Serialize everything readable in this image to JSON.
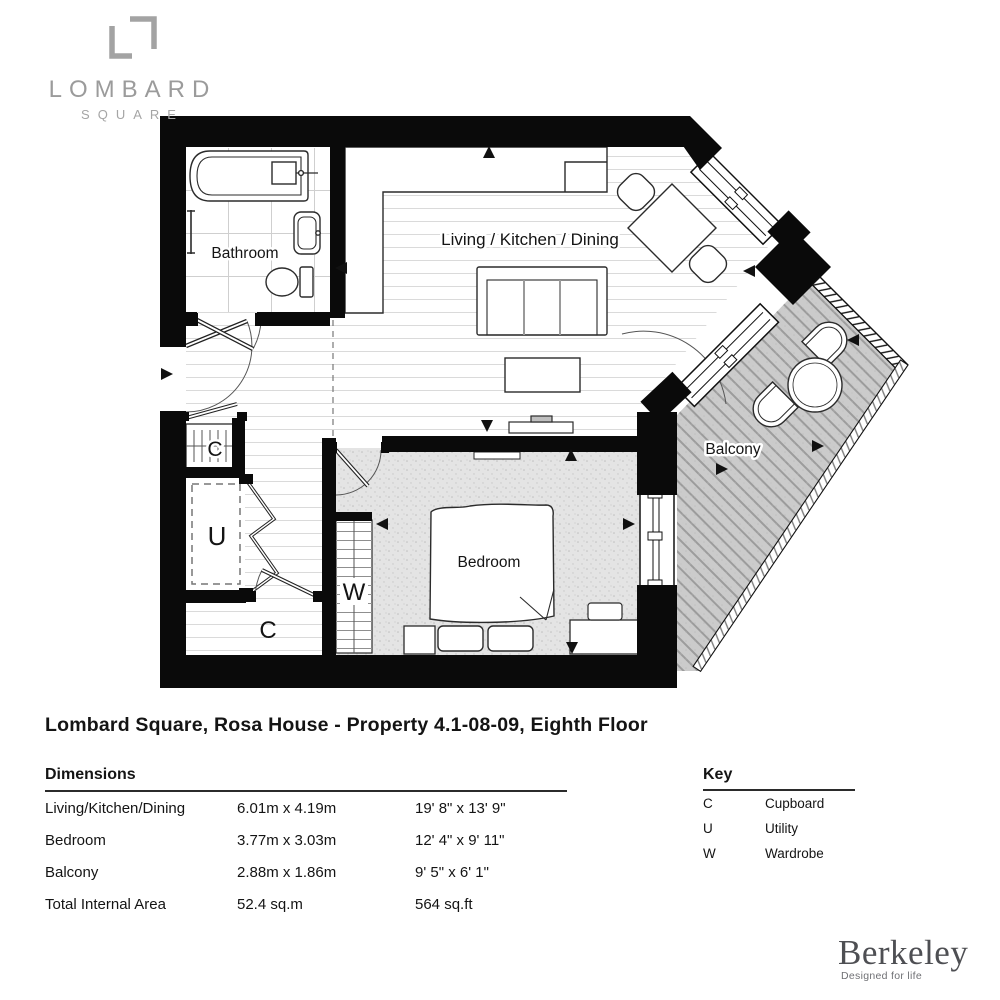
{
  "branding": {
    "logo_line1": "LOMBARD",
    "logo_line2": "SQUARE",
    "logo_glyph_icon": "interlocked-corner-brackets",
    "developer_name": "Berkeley",
    "developer_tagline": "Designed for life"
  },
  "title": "Lombard Square, Rosa House - Property 4.1-08-09, Eighth Floor",
  "plan": {
    "rooms": {
      "living": "Living / Kitchen / Dining",
      "bathroom": "Bathroom",
      "bedroom": "Bedroom",
      "balcony": "Balcony",
      "cupboard_top": "C",
      "utility": "U",
      "cupboard_bottom": "C",
      "wardrobe": "W"
    }
  },
  "dimensions": {
    "heading": "Dimensions",
    "rows": [
      {
        "label": "Living/Kitchen/Dining",
        "metric": "6.01m x 4.19m",
        "imperial": "19' 8\" x 13' 9\""
      },
      {
        "label": "Bedroom",
        "metric": "3.77m x 3.03m",
        "imperial": "12' 4\" x 9' 11\""
      },
      {
        "label": "Balcony",
        "metric": "2.88m x 1.86m",
        "imperial": "9' 5\" x 6' 1\""
      },
      {
        "label": "Total Internal Area",
        "metric": "52.4 sq.m",
        "imperial": "564 sq.ft"
      }
    ]
  },
  "key": {
    "heading": "Key",
    "items": [
      {
        "symbol": "C",
        "meaning": "Cupboard"
      },
      {
        "symbol": "U",
        "meaning": "Utility"
      },
      {
        "symbol": "W",
        "meaning": "Wardrobe"
      }
    ]
  },
  "colors": {
    "wall": "#0a0a0a",
    "carpet": "#e4e4e4",
    "decking": "#cbcbcb",
    "logo_gray": "#9b9b9b",
    "berkeley_gray": "#4e4f53"
  }
}
